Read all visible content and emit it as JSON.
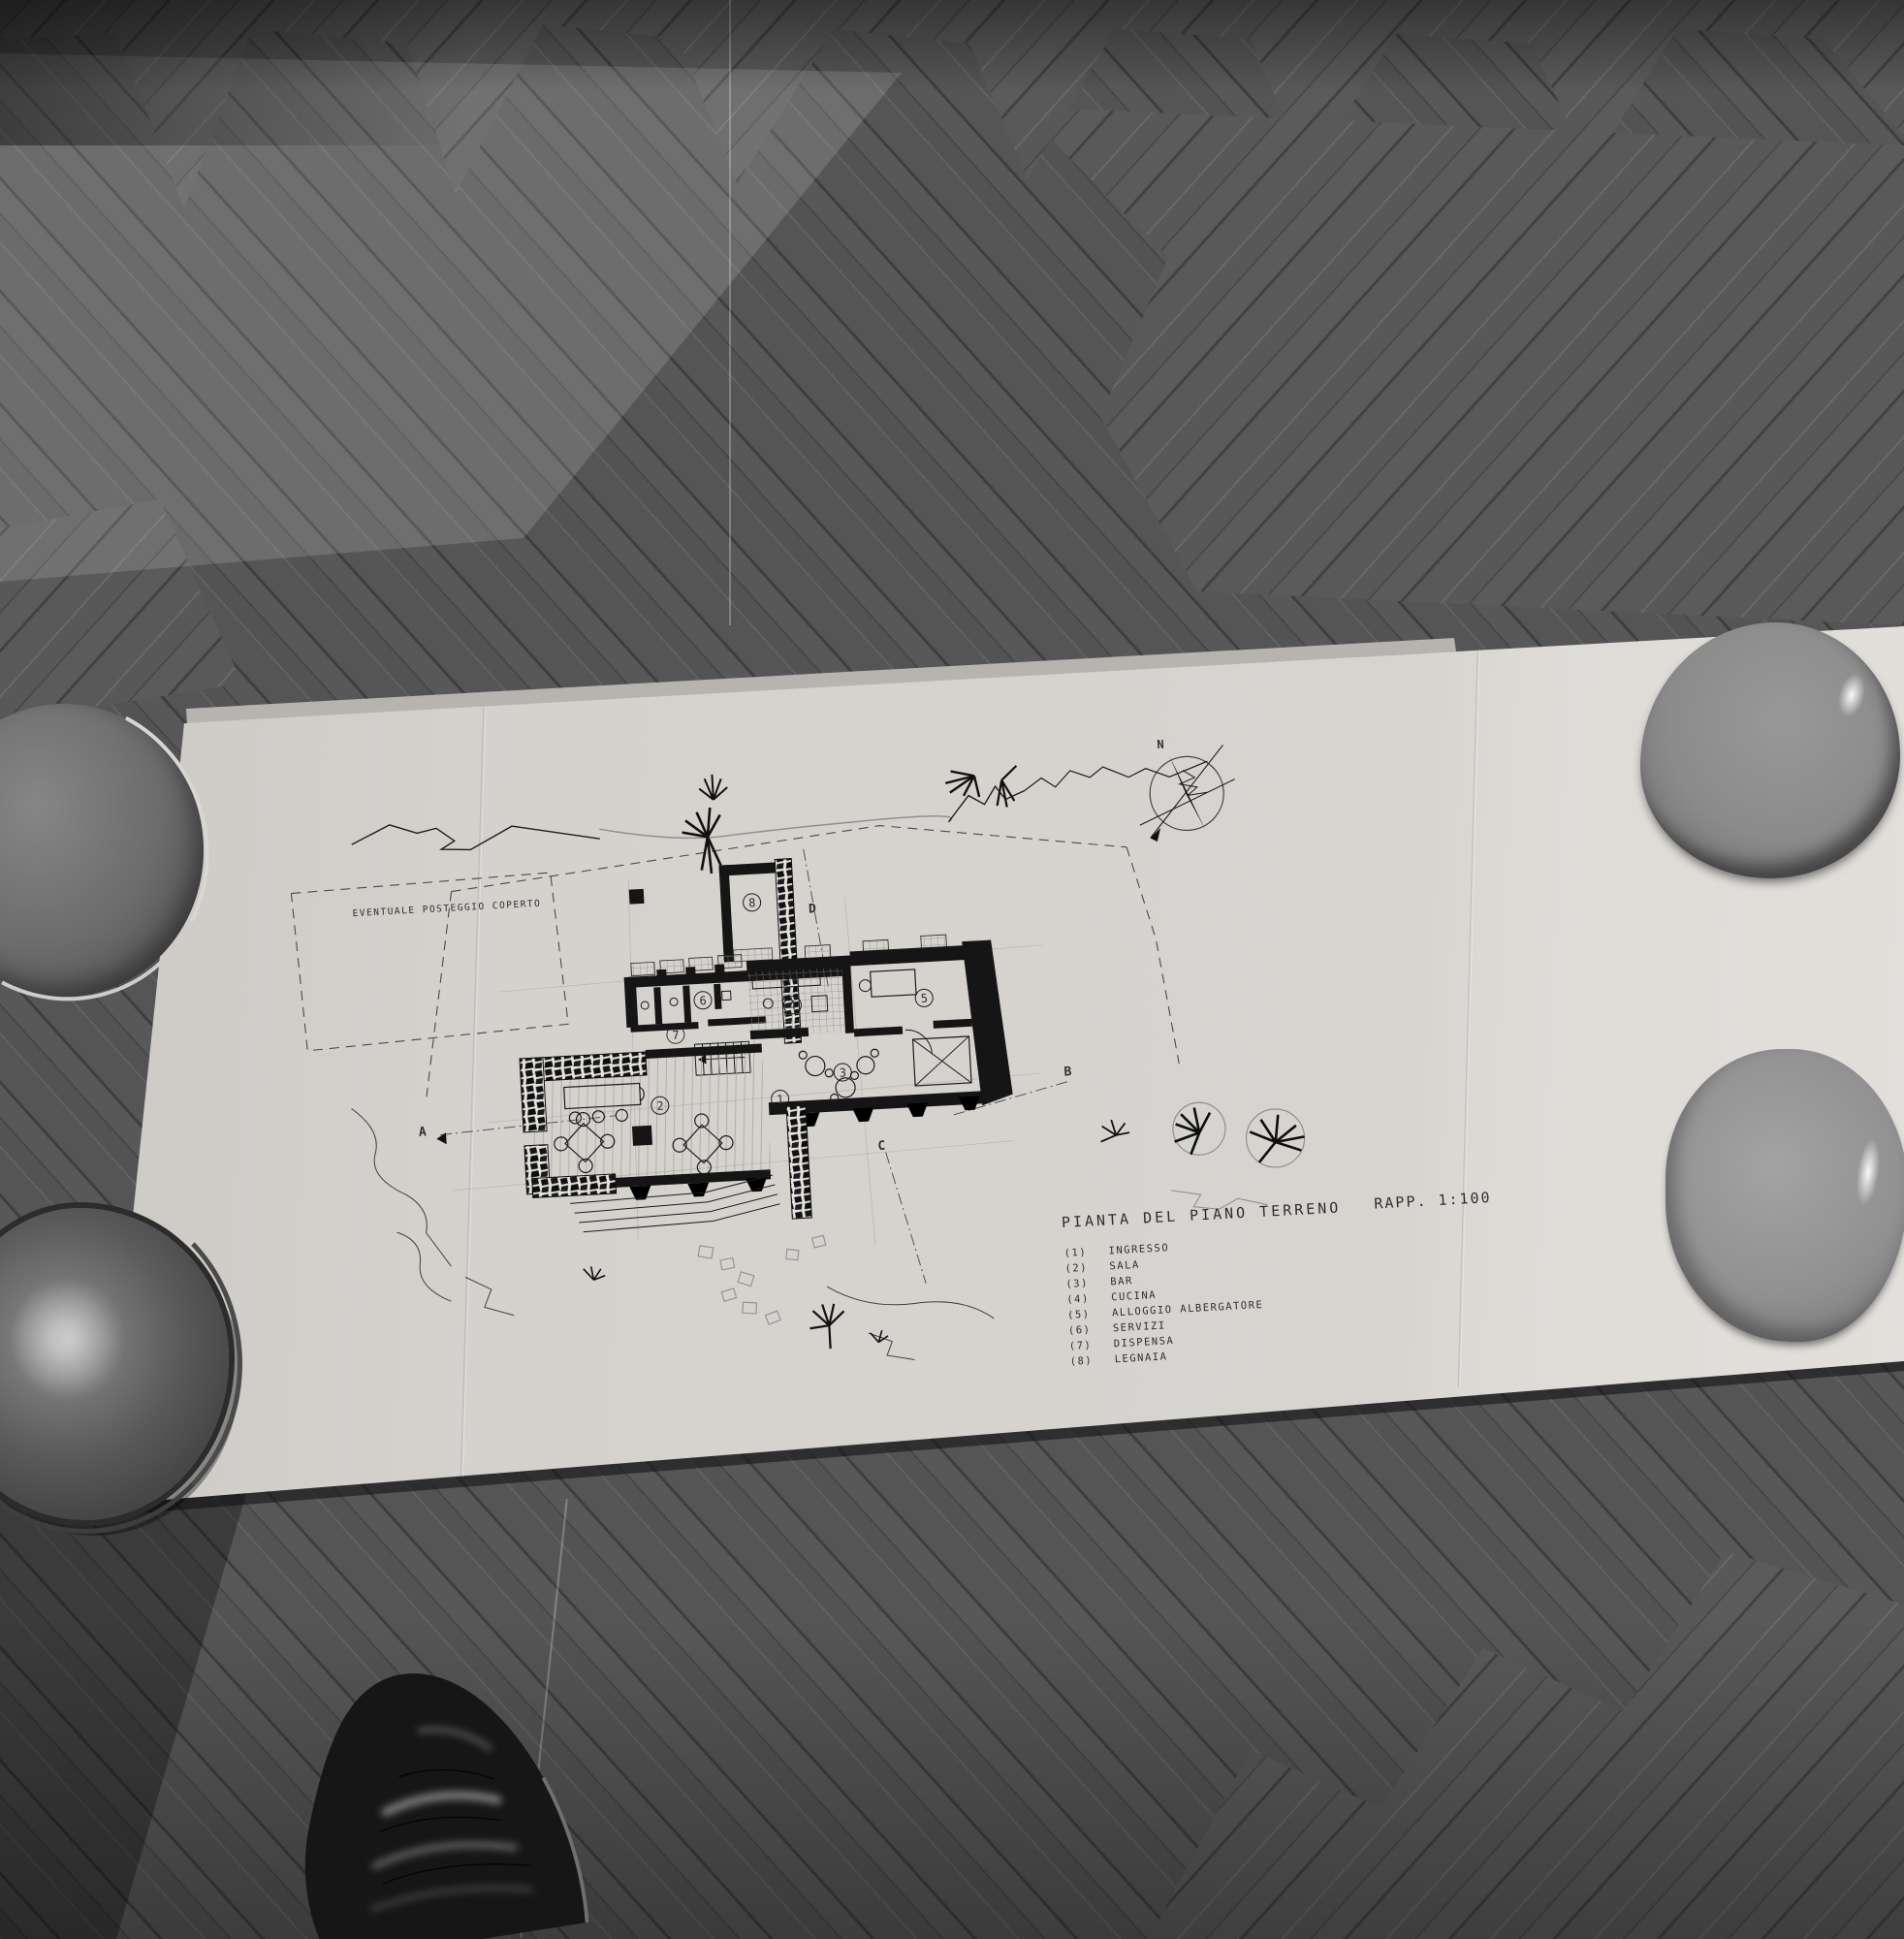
{
  "plan": {
    "title": "PIANTA DEL PIANO TERRENO",
    "scale": "RAPP. 1:100",
    "site_note": "EVENTUALE POSTEGGIO COPERTO",
    "north": "N",
    "sections": {
      "a": "A",
      "b": "B",
      "c": "C",
      "d": "D"
    },
    "legend": [
      {
        "digit": "1",
        "num": "(1)",
        "label": "INGRESSO"
      },
      {
        "digit": "2",
        "num": "(2)",
        "label": "SALA"
      },
      {
        "digit": "3",
        "num": "(3)",
        "label": "BAR"
      },
      {
        "digit": "4",
        "num": "(4)",
        "label": "CUCINA"
      },
      {
        "digit": "5",
        "num": "(5)",
        "label": "ALLOGGIO ALBERGATORE"
      },
      {
        "digit": "6",
        "num": "(6)",
        "label": "SERVIZI"
      },
      {
        "digit": "7",
        "num": "(7)",
        "label": "DISPENSA"
      },
      {
        "digit": "8",
        "num": "(8)",
        "label": "LEGNAIA"
      }
    ]
  },
  "colors": {
    "floor_base": "#515151",
    "paper": "#d6d3cf",
    "paper_right_panel": "#e3e0dc",
    "ink": "#1c1c1c",
    "bowl_dark": "#5a5a5a",
    "bowl_light": "#919191",
    "shoe": "#161616"
  }
}
